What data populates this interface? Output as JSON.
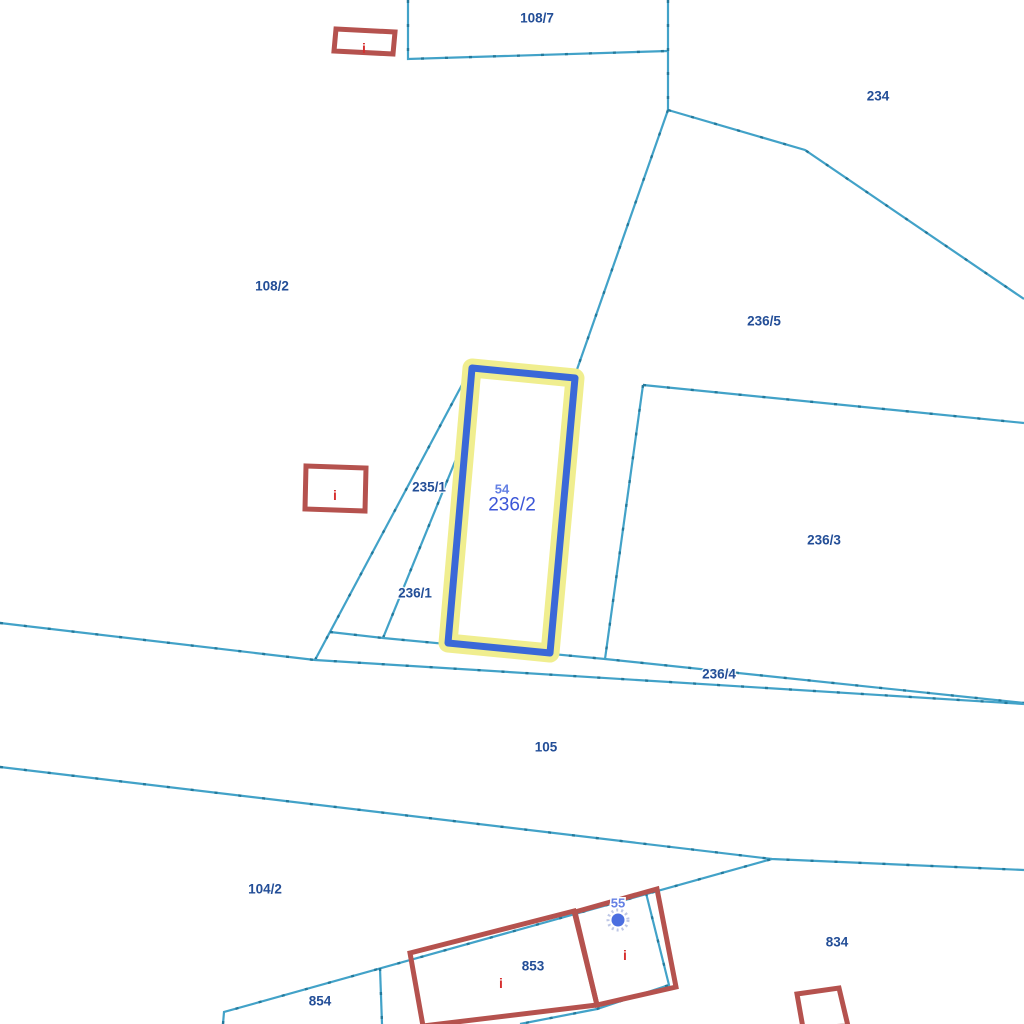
{
  "map": {
    "width": 1024,
    "height": 1024,
    "background": "#ffffff",
    "selected_parcel": "236/2"
  },
  "colors": {
    "boundary_line": "#42a2c8",
    "boundary_tick": "#1d7293",
    "building_outline": "#b5524e",
    "parcel_label": "#234e97",
    "selected_label": "#3c56d8",
    "address_label": "#6480e4",
    "info_icon": "#d62f2f",
    "highlight_stroke": "#3a68d8",
    "highlight_halo": "#f0ee8f",
    "point_marker": "#4c6fe0"
  },
  "boundaries": [
    {
      "name": "parcel-108-7-west-south",
      "points": [
        [
          408,
          0
        ],
        [
          408,
          59
        ],
        [
          668,
          51
        ]
      ]
    },
    {
      "name": "parcel-108-7-east",
      "points": [
        [
          668,
          0
        ],
        [
          668,
          110
        ]
      ]
    },
    {
      "name": "parcel-234-southwest",
      "points": [
        [
          668,
          110
        ],
        [
          805,
          150
        ],
        [
          1024,
          299
        ]
      ]
    },
    {
      "name": "boundary-236-5-west",
      "points": [
        [
          668,
          110
        ],
        [
          574,
          378
        ]
      ]
    },
    {
      "name": "boundary-235-1-west",
      "points": [
        [
          315,
          660
        ],
        [
          471,
          368
        ]
      ]
    },
    {
      "name": "boundary-236-1-east",
      "points": [
        [
          383,
          638
        ],
        [
          472,
          420
        ]
      ]
    },
    {
      "name": "boundary-236-4-north",
      "points": [
        [
          330,
          632
        ],
        [
          383,
          638
        ],
        [
          605,
          659
        ],
        [
          1024,
          703
        ]
      ]
    },
    {
      "name": "road-north-edge",
      "points": [
        [
          0,
          623
        ],
        [
          315,
          660
        ],
        [
          1024,
          704
        ]
      ]
    },
    {
      "name": "parcel-236-3-north",
      "points": [
        [
          643,
          385
        ],
        [
          1024,
          423
        ]
      ]
    },
    {
      "name": "parcel-236-3-west",
      "points": [
        [
          643,
          385
        ],
        [
          605,
          659
        ]
      ]
    },
    {
      "name": "road-south-edge",
      "points": [
        [
          0,
          767
        ],
        [
          772,
          859
        ],
        [
          1024,
          870
        ]
      ]
    },
    {
      "name": "south-block-north-edge",
      "points": [
        [
          223,
          1024
        ],
        [
          224,
          1012
        ],
        [
          772,
          859
        ]
      ]
    },
    {
      "name": "boundary-854-853",
      "points": [
        [
          380,
          968
        ],
        [
          382,
          1024
        ]
      ]
    },
    {
      "name": "boundary-east-of-55",
      "points": [
        [
          646,
          893
        ],
        [
          669,
          985
        ],
        [
          597,
          1009
        ],
        [
          520,
          1024
        ]
      ]
    }
  ],
  "buildings": [
    {
      "name": "building-top-left",
      "points": [
        [
          336,
          29
        ],
        [
          395,
          32
        ],
        [
          393,
          54
        ],
        [
          334,
          51
        ]
      ]
    },
    {
      "name": "building-left",
      "points": [
        [
          306,
          466
        ],
        [
          366,
          468
        ],
        [
          365,
          511
        ],
        [
          305,
          509
        ]
      ]
    },
    {
      "name": "building-853",
      "points": [
        [
          410,
          953
        ],
        [
          574,
          911
        ],
        [
          597,
          1005
        ],
        [
          423,
          1026
        ]
      ]
    },
    {
      "name": "building-55",
      "points": [
        [
          575,
          912
        ],
        [
          657,
          889
        ],
        [
          676,
          987
        ],
        [
          597,
          1005
        ]
      ]
    },
    {
      "name": "building-834",
      "points": [
        [
          797,
          994
        ],
        [
          839,
          988
        ],
        [
          848,
          1026
        ],
        [
          803,
          1028
        ]
      ]
    }
  ],
  "highlight": {
    "name": "selected-parcel-236-2",
    "points": [
      [
        472,
        368
      ],
      [
        575,
        378
      ],
      [
        550,
        653
      ],
      [
        448,
        643
      ]
    ]
  },
  "point_marker": {
    "x": 618,
    "y": 920
  },
  "labels": [
    {
      "text": "108/7",
      "x": 537,
      "y": 18,
      "kind": "parcel"
    },
    {
      "text": "234",
      "x": 878,
      "y": 96,
      "kind": "parcel"
    },
    {
      "text": "108/2",
      "x": 272,
      "y": 286,
      "kind": "parcel"
    },
    {
      "text": "236/5",
      "x": 764,
      "y": 321,
      "kind": "parcel"
    },
    {
      "text": "235/1",
      "x": 429,
      "y": 487,
      "kind": "parcel"
    },
    {
      "text": "236/1",
      "x": 415,
      "y": 593,
      "kind": "parcel"
    },
    {
      "text": "236/3",
      "x": 824,
      "y": 540,
      "kind": "parcel"
    },
    {
      "text": "236/4",
      "x": 719,
      "y": 674,
      "kind": "parcel"
    },
    {
      "text": "105",
      "x": 546,
      "y": 747,
      "kind": "parcel"
    },
    {
      "text": "104/2",
      "x": 265,
      "y": 889,
      "kind": "parcel"
    },
    {
      "text": "854",
      "x": 320,
      "y": 1001,
      "kind": "parcel"
    },
    {
      "text": "853",
      "x": 533,
      "y": 966,
      "kind": "parcel"
    },
    {
      "text": "834",
      "x": 837,
      "y": 942,
      "kind": "parcel"
    },
    {
      "text": "54",
      "x": 502,
      "y": 489,
      "kind": "address"
    },
    {
      "text": "236/2",
      "x": 512,
      "y": 505,
      "kind": "selected"
    },
    {
      "text": "55",
      "x": 618,
      "y": 903,
      "kind": "address"
    },
    {
      "text": "i",
      "x": 364,
      "y": 48,
      "kind": "info"
    },
    {
      "text": "i",
      "x": 335,
      "y": 495,
      "kind": "info"
    },
    {
      "text": "i",
      "x": 501,
      "y": 983,
      "kind": "info"
    },
    {
      "text": "i",
      "x": 625,
      "y": 955,
      "kind": "info"
    }
  ]
}
